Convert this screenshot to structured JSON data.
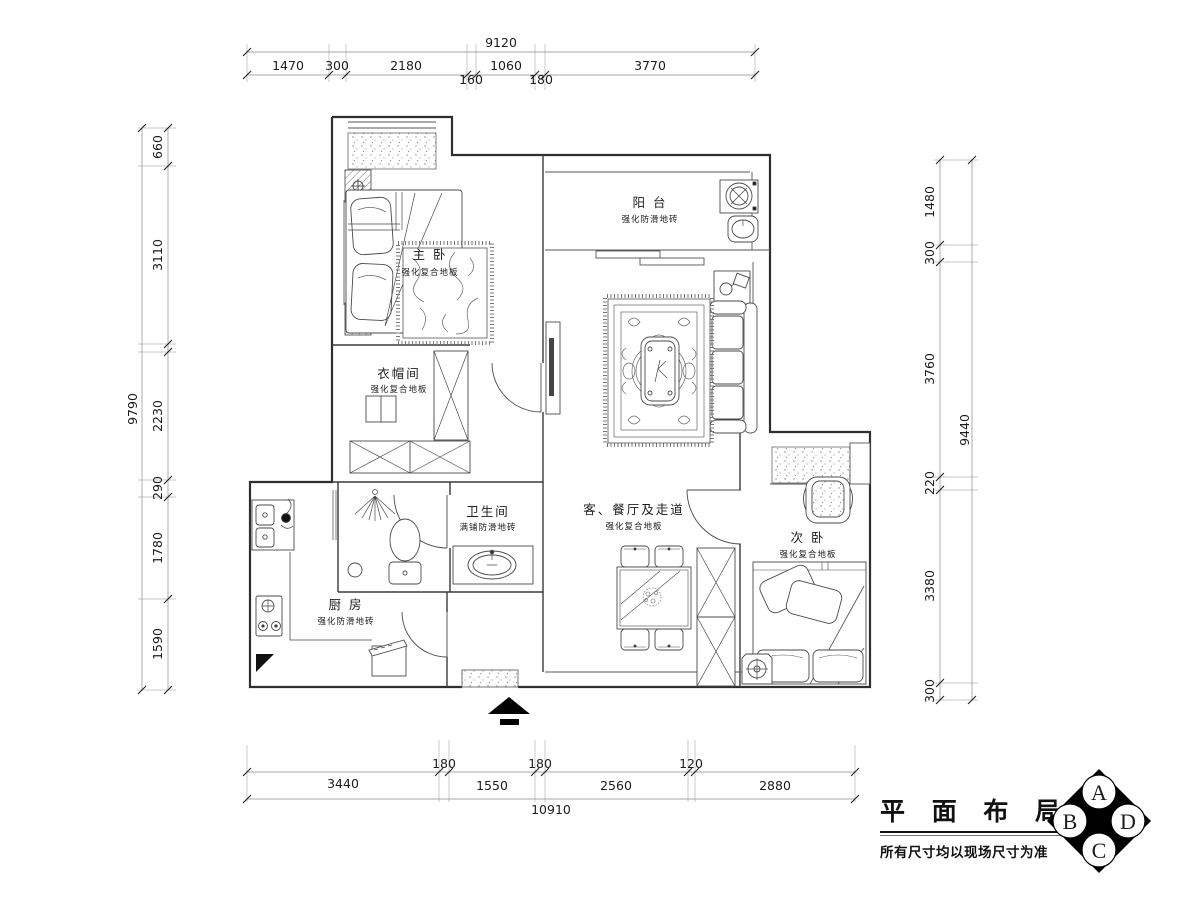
{
  "title_block": {
    "title": "平 面 布 局 图",
    "note": "所有尺寸均以现场尺寸为准",
    "compass": {
      "a": "A",
      "b": "B",
      "c": "C",
      "d": "D"
    }
  },
  "rooms": {
    "master": {
      "name": "主 卧",
      "floor": "强化复合地板"
    },
    "balcony": {
      "name": "阳 台",
      "floor": "强化防滑地砖"
    },
    "closet": {
      "name": "衣帽间",
      "floor": "强化复合地板"
    },
    "bath": {
      "name": "卫生间",
      "floor": "满铺防滑地砖"
    },
    "living": {
      "name": "客、餐厅及走道",
      "floor": "强化复合地板"
    },
    "second": {
      "name": "次 卧",
      "floor": "强化复合地板"
    },
    "kitchen": {
      "name": "厨 房",
      "floor": "强化防滑地砖"
    }
  },
  "dimensions": {
    "top": {
      "total": "9120",
      "segments": [
        "1470",
        "300",
        "2180",
        "160",
        "1060",
        "180",
        "3770"
      ]
    },
    "bottom": {
      "total": "10910",
      "segments": [
        "3440",
        "180",
        "1550",
        "180",
        "2560",
        "120",
        "2880"
      ]
    },
    "left": {
      "total": "9790",
      "segments": [
        "660",
        "3110",
        "2230",
        "290",
        "1780",
        "1590"
      ]
    },
    "right": {
      "total": "9440",
      "segments": [
        "1480",
        "300",
        "3760",
        "220",
        "3380",
        "300"
      ]
    }
  }
}
